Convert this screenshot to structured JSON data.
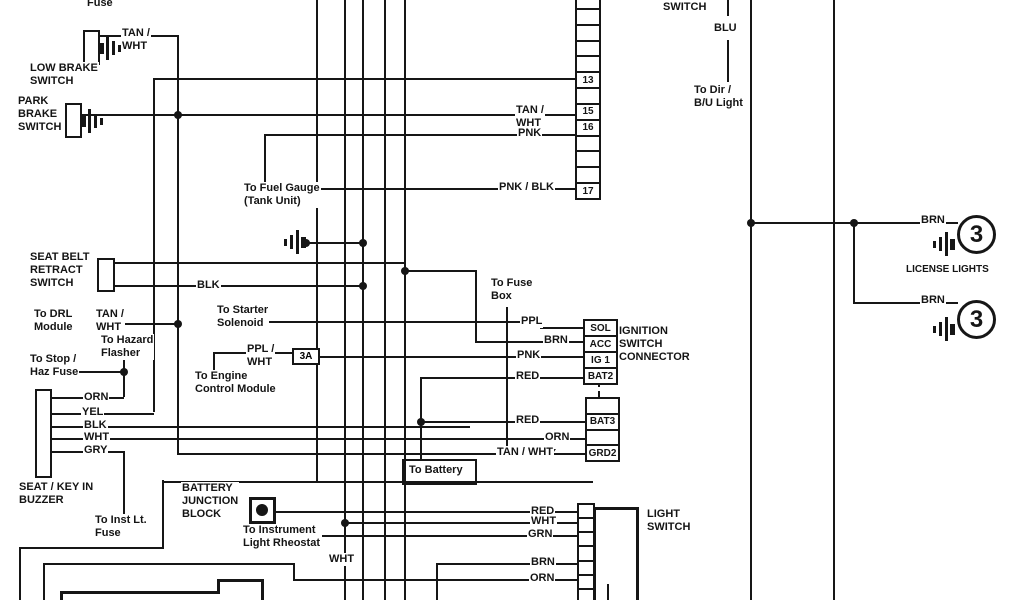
{
  "title": "Automotive wiring diagram",
  "labels": {
    "fuse_top": {
      "text": "Fuse"
    },
    "tanwht_lowbrake": {
      "text": "TAN /\nWHT"
    },
    "low_brake": {
      "text": "LOW BRAKE\nSWITCH"
    },
    "park_brake": {
      "text": "PARK\nBRAKE\nSWITCH"
    },
    "fuel_gauge": {
      "text": "To Fuel Gauge\n(Tank Unit)"
    },
    "seat_belt": {
      "text": "SEAT BELT\nRETRACT\nSWITCH"
    },
    "blk_seatbelt": {
      "text": "BLK"
    },
    "to_drl": {
      "text": "To DRL\nModule"
    },
    "tanwht_drl": {
      "text": "TAN /\nWHT"
    },
    "to_hazard": {
      "text": "To Hazard\nFlasher"
    },
    "to_stop": {
      "text": "To Stop /\nHaz Fuse"
    },
    "to_starter": {
      "text": "To Starter\nSolenoid"
    },
    "ppl_wht": {
      "text": "PPL /\nWHT"
    },
    "to_engine": {
      "text": "To Engine\nControl Module"
    },
    "orn_buzzer": {
      "text": "ORN"
    },
    "yel_buzzer": {
      "text": "YEL"
    },
    "blk_buzzer": {
      "text": "BLK"
    },
    "wht_buzzer": {
      "text": "WHT"
    },
    "gry_buzzer": {
      "text": "GRY"
    },
    "seat_key": {
      "text": "SEAT / KEY IN\nBUZZER"
    },
    "to_inst": {
      "text": "To Inst Lt.\nFuse"
    },
    "battery_junction": {
      "text": "BATTERY\nJUNCTION\nBLOCK"
    },
    "to_rheostat": {
      "text": "To Instrument\nLight Rheostat"
    },
    "wht_down": {
      "text": "WHT"
    },
    "to_fuse_box": {
      "text": "To Fuse\nBox"
    },
    "ppl": {
      "text": "PPL"
    },
    "brn_acc": {
      "text": "BRN"
    },
    "pnk_ig": {
      "text": "PNK"
    },
    "red_bat2": {
      "text": "RED"
    },
    "red_bat3": {
      "text": "RED"
    },
    "orn_lower": {
      "text": "ORN"
    },
    "tanwht_grd": {
      "text": "TAN / WHT"
    },
    "to_battery": {
      "text": "To Battery"
    },
    "ignition": {
      "text": "IGNITION\nSWITCH\nCONNECTOR"
    },
    "switch_top": {
      "text": "SWITCH"
    },
    "blu": {
      "text": "BLU"
    },
    "to_dir": {
      "text": "To Dir /\nB/U Light"
    },
    "brn_lic1": {
      "text": "BRN"
    },
    "license": {
      "text": "LICENSE LIGHTS"
    },
    "brn_lic2": {
      "text": "BRN"
    },
    "tanwht_15": {
      "text": "TAN /\nWHT"
    },
    "pnk_16": {
      "text": "PNK"
    },
    "pnk_blk": {
      "text": "PNK / BLK"
    },
    "light_switch": {
      "text": "LIGHT\nSWITCH"
    },
    "red_ls": {
      "text": "RED"
    },
    "wht_ls": {
      "text": "WHT"
    },
    "grn_ls": {
      "text": "GRN"
    },
    "brn_ls": {
      "text": "BRN"
    },
    "orn_ls": {
      "text": "ORN"
    },
    "fuse_3a": {
      "text": "3A"
    }
  },
  "connectors": {
    "main": {
      "cells": [
        "",
        "",
        "",
        "",
        "",
        "13",
        "",
        "15",
        "16",
        "",
        "",
        "",
        "17"
      ]
    },
    "ignition": {
      "cells": [
        "SOL",
        "ACC",
        "IG 1",
        "BAT2"
      ]
    },
    "lower": {
      "cells": [
        "",
        "BAT3",
        "",
        "GRD2"
      ]
    }
  },
  "bulbs": {
    "filament": "3"
  },
  "colors": {
    "line": "#161616",
    "background": "#ffffff"
  }
}
